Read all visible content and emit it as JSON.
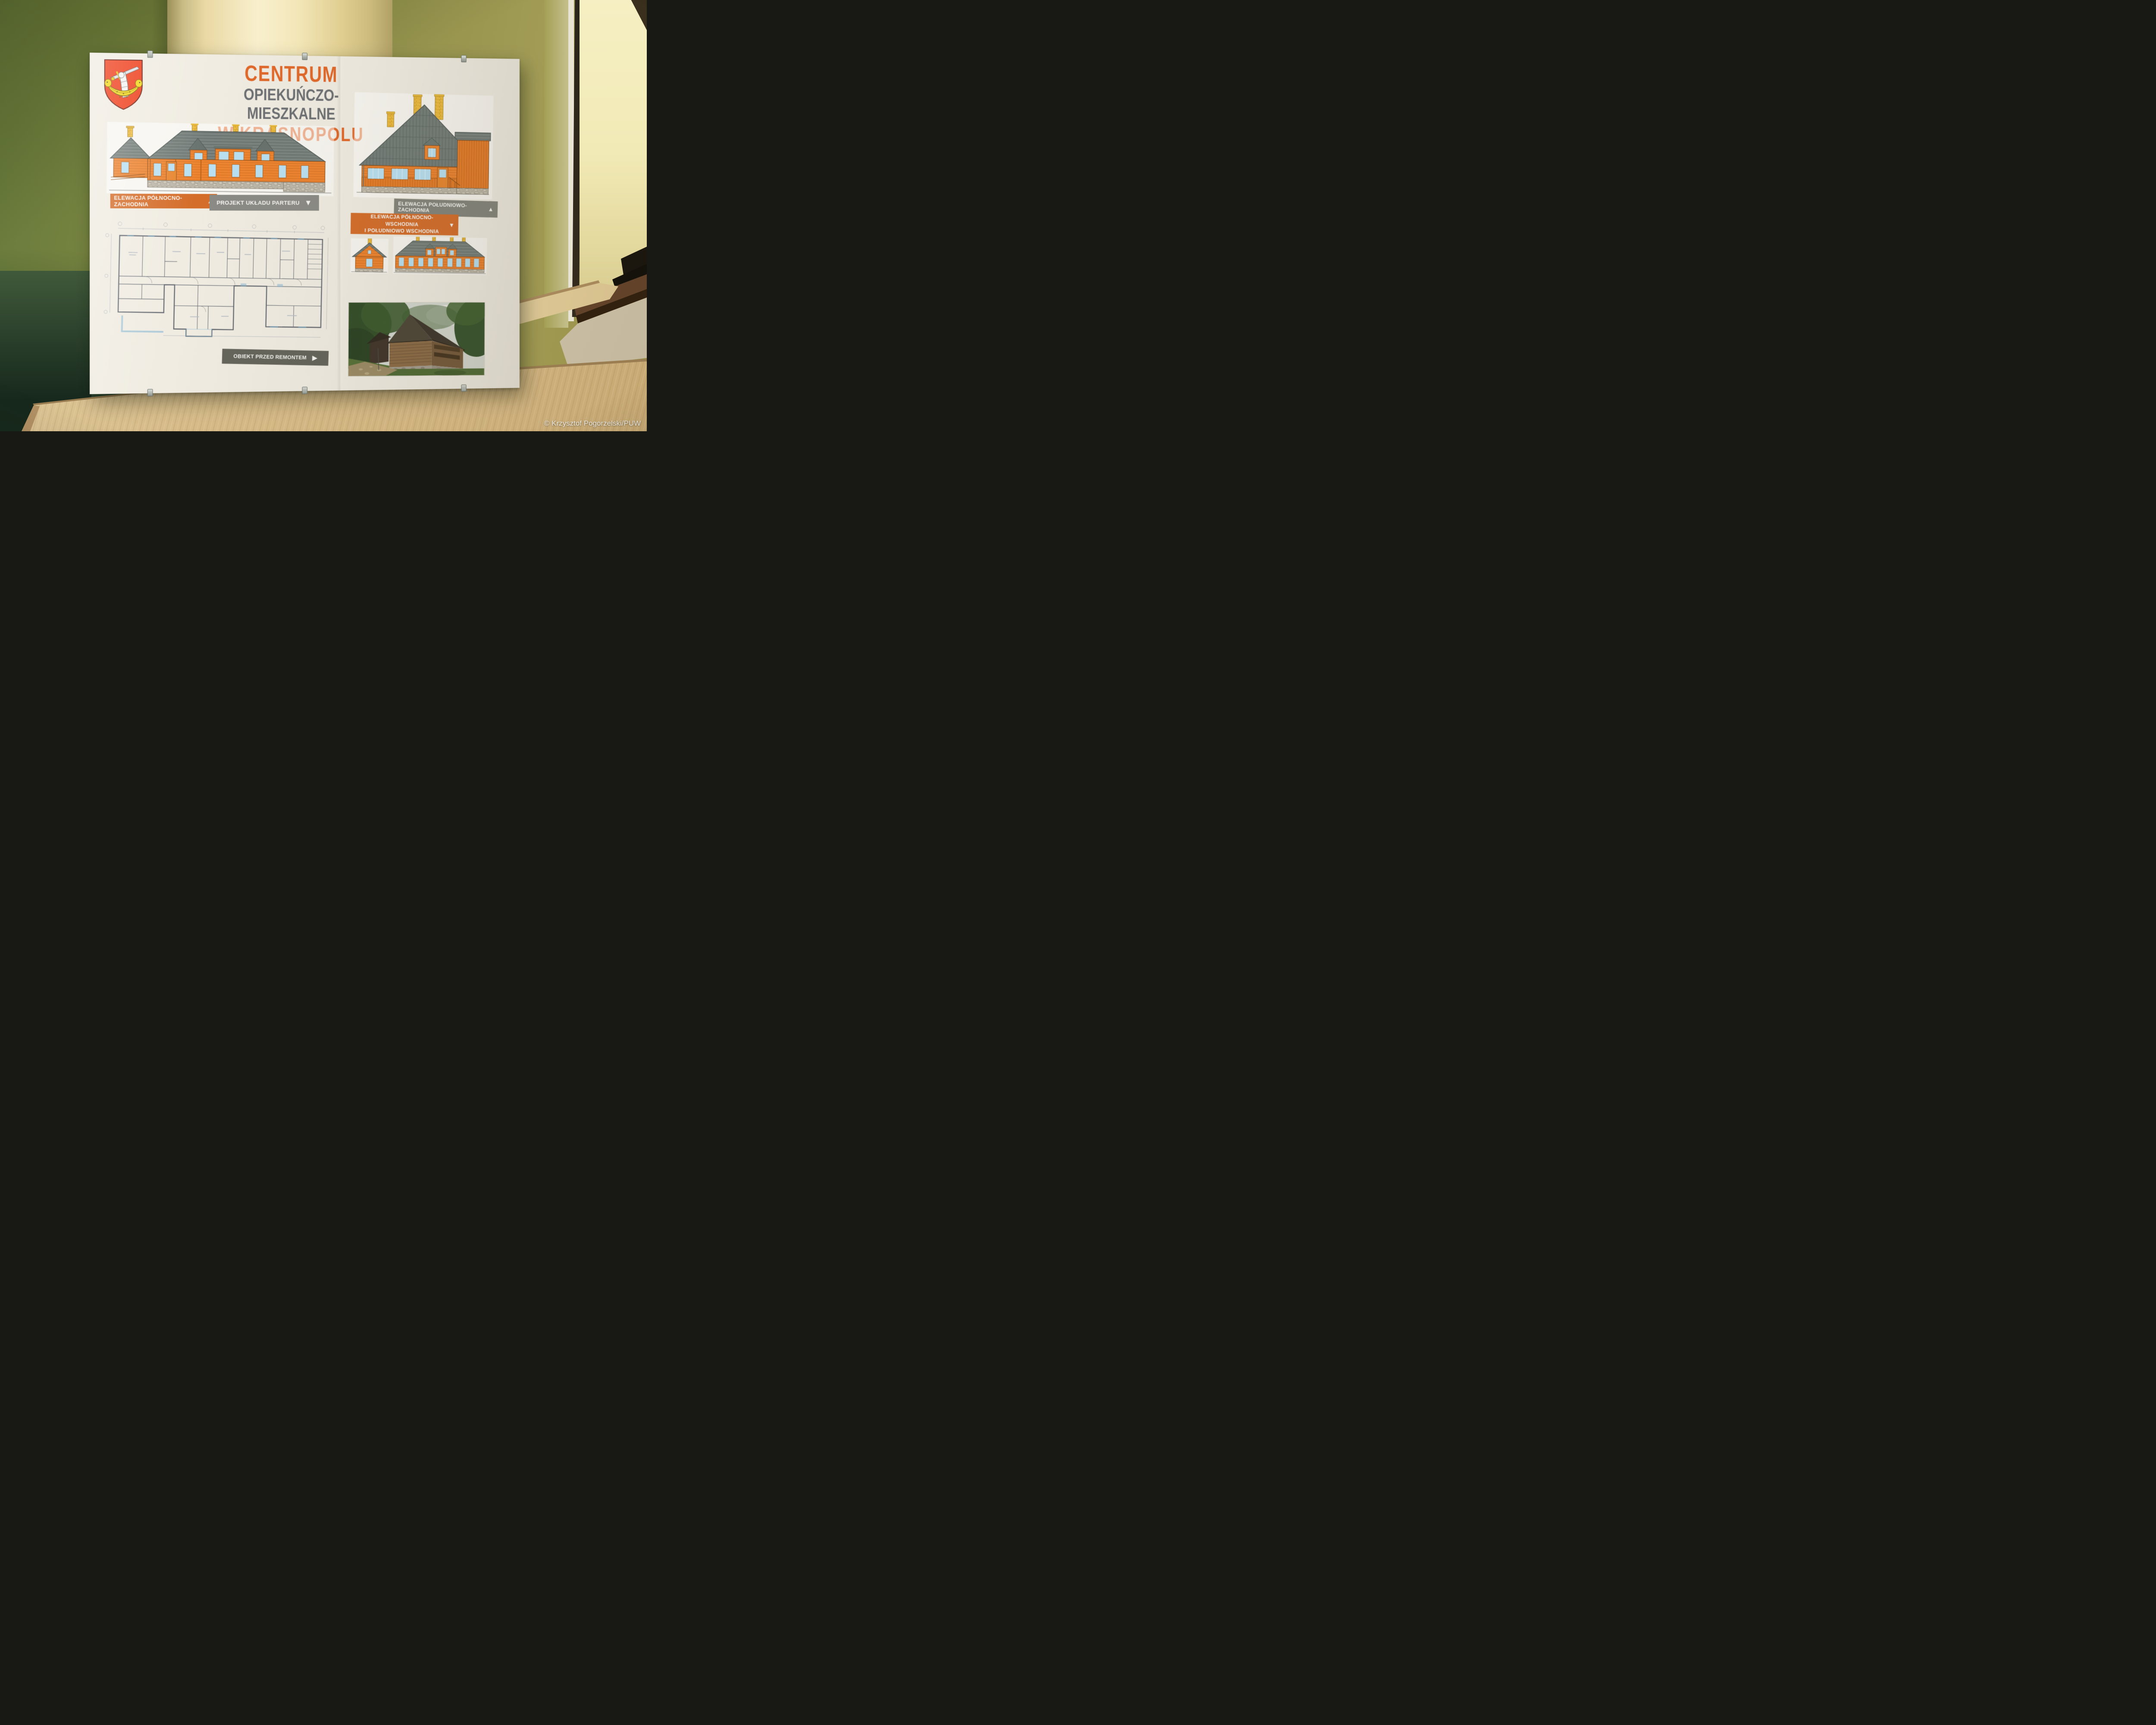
{
  "scene": {
    "photo_credit": "© Krzysztof Pogorzelski/PUW"
  },
  "poster": {
    "title_line1": "CENTRUM",
    "title_line2": "OPIEKUŃCZO-MIESZKALNE",
    "title_line3": "W KRASNOPOLU",
    "labels": {
      "elev_nw": "ELEWACJA PÓŁNOCNO-ZACHODNIA",
      "plan_parter": "PROJEKT UKŁADU PARTERU",
      "elev_sw": "ELEWACJA POŁUDNIOWO-ZACHODNIA",
      "elev_ne_se_line1": "ELEWACJA PÓŁNOCNO-WSCHODNIA",
      "elev_ne_se_line2": "I POŁUDNIOWO WSCHODNIA",
      "before_renovation": "OBIEKT PRZED REMONTEM"
    },
    "icons": {
      "up_triangle": "▲",
      "down_triangle": "▼",
      "right_triangle": "▶"
    },
    "colors": {
      "accent_orange": "#d46d2a",
      "label_gray": "#8b8b86",
      "label_dark_gray": "#64645b",
      "title_orange": "#e0682a",
      "title_gray": "#6d7073",
      "building_orange": "#ee8430",
      "roof_gray": "#7a837f",
      "window_blue": "#b8e0f2",
      "chimney_yellow": "#f0c043",
      "crest_red": "#ee3a16",
      "crest_yellow": "#f2d713"
    }
  }
}
